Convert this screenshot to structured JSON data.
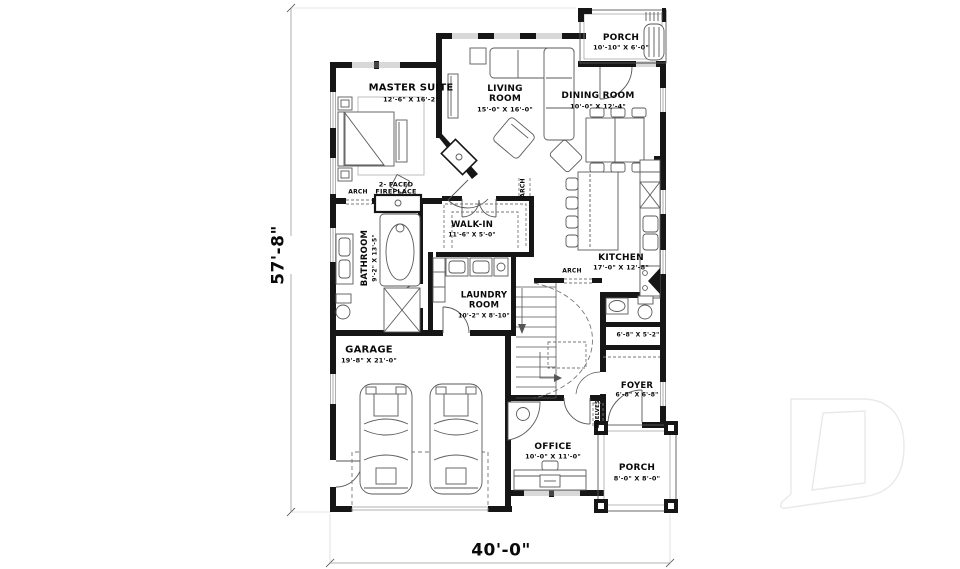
{
  "plan": {
    "overall_height": "57'-8\"",
    "overall_width": "40'-0\"",
    "rooms": {
      "master_suite": {
        "name": "MASTER SUITE",
        "dims": "12'-6\" X 16'-2\""
      },
      "living_room": {
        "name": "LIVING ROOM",
        "dims": "15'-0\" X 16'-0\""
      },
      "dining_room": {
        "name": "DINING ROOM",
        "dims": "10'-0\" X 12'-4\""
      },
      "porch_rear": {
        "name": "PORCH",
        "dims": "10'-10\" X 6'-0\""
      },
      "kitchen": {
        "name": "KITCHEN",
        "dims": "17'-0\" X 12'-8\""
      },
      "walk_in": {
        "name": "WALK-IN",
        "dims": "11'-6\" X 5'-0\""
      },
      "bathroom": {
        "name": "BATHROOM",
        "dims": "9'-2\" X 13'-5\""
      },
      "laundry_room": {
        "name": "LAUNDRY ROOM",
        "dims": "10'-2\" X 8'-10\""
      },
      "garage": {
        "name": "GARAGE",
        "dims": "19'-8\" X 21'-0\""
      },
      "powder_room": {
        "dims": "6'-8\" X 5'-2\""
      },
      "foyer": {
        "name": "FOYER",
        "dims": "6'-8\" X 6'-8\""
      },
      "office": {
        "name": "OFFICE",
        "dims": "10'-0\" X 11'-0\""
      },
      "porch_front": {
        "name": "PORCH",
        "dims": "8'-0\" X 8'-0\""
      }
    },
    "annotations": {
      "fireplace": "2- FACED FIREPLACE",
      "arch": "ARCH",
      "shelves": "SHELVES"
    },
    "colors": {
      "wall": "#161616",
      "furniture_line": "#5a5a5a",
      "light_line": "#9a9a9a",
      "watermark": "#e9e9e9"
    }
  }
}
